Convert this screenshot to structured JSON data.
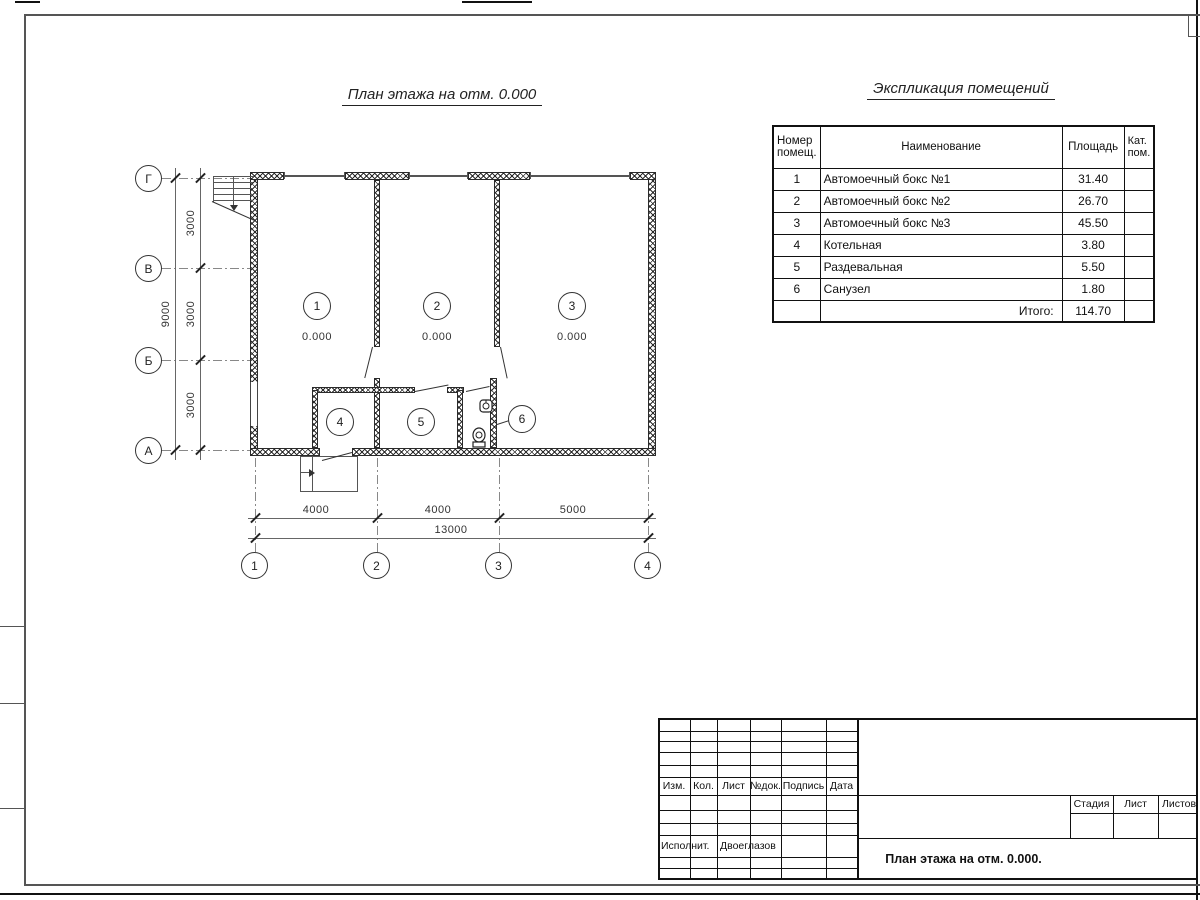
{
  "sheet": {
    "plan_title": "План этажа на отм. 0.000",
    "elevation": "0.000",
    "room_tags": [
      "1",
      "2",
      "3",
      "4",
      "5",
      "6"
    ],
    "axes_rows": [
      "Г",
      "В",
      "Б",
      "А"
    ],
    "axes_cols": [
      "1",
      "2",
      "3",
      "4"
    ],
    "dims": {
      "v_segments": [
        "3000",
        "3000",
        "3000"
      ],
      "v_total": "9000",
      "h_segments": [
        "4000",
        "4000",
        "5000"
      ],
      "h_total": "13000"
    }
  },
  "schedule": {
    "title": "Экспликация помещений",
    "col_number": "Номер помещ.",
    "col_name": "Наименование",
    "col_area": "Площадь",
    "col_cat": "Кат. пом.",
    "rows": [
      {
        "num": "1",
        "name": "Автомоечный бокс №1",
        "area": "31.40",
        "cat": ""
      },
      {
        "num": "2",
        "name": "Автомоечный бокс №2",
        "area": "26.70",
        "cat": ""
      },
      {
        "num": "3",
        "name": "Автомоечный бокс №3",
        "area": "45.50",
        "cat": ""
      },
      {
        "num": "4",
        "name": "Котельная",
        "area": "3.80",
        "cat": ""
      },
      {
        "num": "5",
        "name": "Раздевальная",
        "area": "5.50",
        "cat": ""
      },
      {
        "num": "6",
        "name": "Санузел",
        "area": "1.80",
        "cat": ""
      }
    ],
    "total_label": "Итого:",
    "total_area": "114.70"
  },
  "title_block": {
    "cols": [
      "Изм.",
      "Кол.",
      "Лист",
      "№док.",
      "Подпись",
      "Дата"
    ],
    "executor_label": "Исполнит.",
    "executor_name": "Двоеглазов",
    "stage_label": "Стадия",
    "sheet_label": "Лист",
    "sheets_label": "Листов",
    "doc_title": "План этажа на отм. 0.000."
  }
}
